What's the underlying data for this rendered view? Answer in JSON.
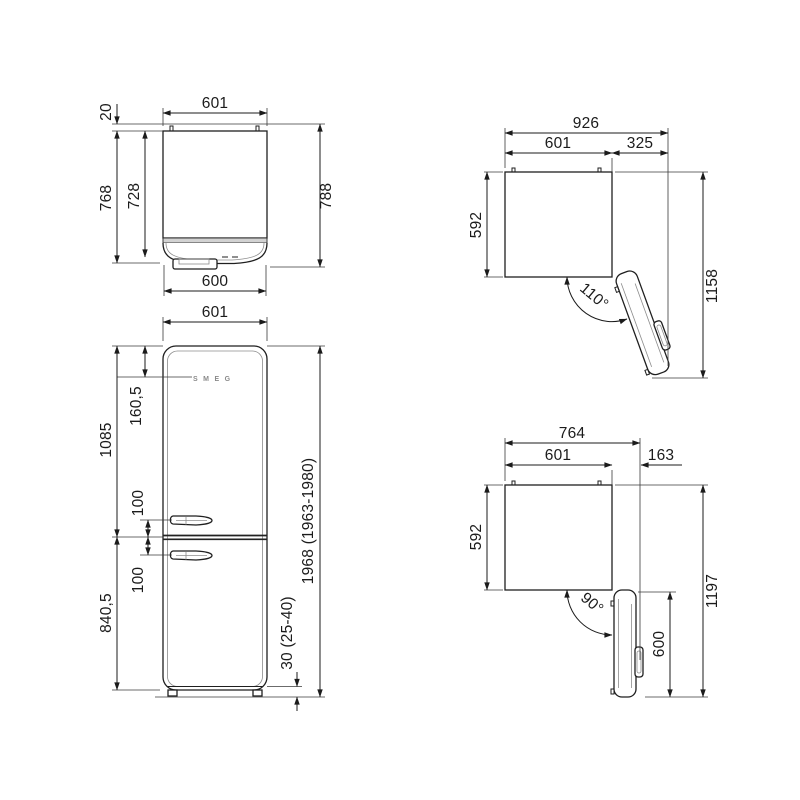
{
  "drawing": {
    "logo": "SMEG",
    "views": {
      "top_closed": {
        "width_top": "601",
        "hinge_offset": "20",
        "depth_with_door": "768",
        "depth_body": "728",
        "depth_total": "788",
        "width_door": "600"
      },
      "open110": {
        "total_width": "926",
        "body_width": "601",
        "door_side_protrusion": "325",
        "body_depth": "592",
        "open_angle": "110°",
        "total_depth_open": "1158"
      },
      "front": {
        "width": "601",
        "top_to_controls": "160,5",
        "upper_section_height": "1085",
        "handle_gap_upper": "100",
        "handle_gap_lower": "100",
        "lower_section_height": "840,5",
        "total_height": "1968 (1963-1980)",
        "feet_height": "30 (25-40)"
      },
      "open90": {
        "total_width": "764",
        "body_width": "601",
        "door_side_protrusion": "163",
        "body_depth": "592",
        "open_angle": "90°",
        "door_depth": "600",
        "total_depth_open": "1197"
      }
    }
  }
}
